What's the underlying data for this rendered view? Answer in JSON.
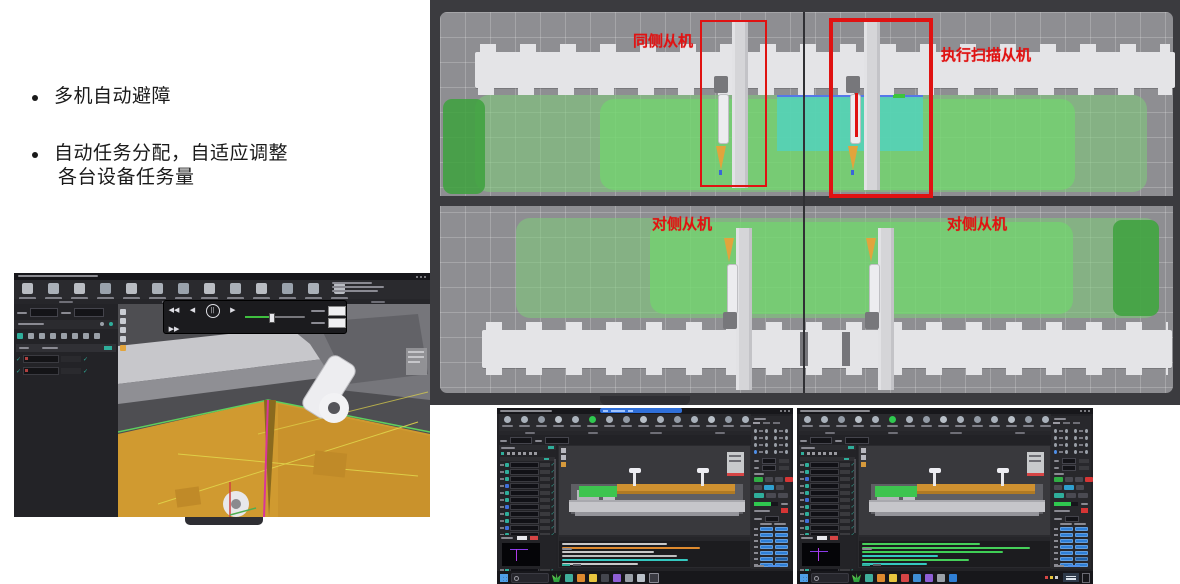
{
  "slide": {
    "bullet1": "多机自动避障",
    "bullet2_line1": "自动任务分配，自适应调整",
    "bullet2_line2": "各台设备任务量",
    "text_color": "#1a1a1a"
  },
  "sim_view": {
    "labels": {
      "same_side": "同侧从机",
      "scan_executor": "执行扫描从机",
      "opposite_left": "对侧从机",
      "opposite_right": "对侧从机"
    },
    "colors": {
      "annotation_red": "#e01212",
      "pale_green_zone": "#8fd48c",
      "bright_green_zone": "#7bdc78",
      "dark_green_zone": "#3da23d",
      "teal_zone": "#5ed2c4",
      "floor_gray": "#8e8e92",
      "frame_dark": "#3b3b3f",
      "rail_white": "#e4e4e7",
      "machine_gray": "#d5d5d8",
      "effector_orange": "#e2a43c",
      "scan_line_red": "#e01010"
    }
  },
  "viewer": {
    "toolbar_icons": [
      "#b9bcc2",
      "#aab0b8",
      "#b9bcc2",
      "#9aa2ac",
      "#b9bcc2",
      "#aab0b8",
      "#9aa2ac",
      "#b9bcc2",
      "#aab0b8",
      "#b9bcc2",
      "#9aa2ac",
      "#aab0b8",
      "#b9bcc2"
    ],
    "vstrip_icons": [
      "#c9ccd2",
      "#c9ccd2",
      "#c9ccd2",
      "#c9ccd2",
      "#e2a43c"
    ],
    "left_icons": [
      "#2fae9b",
      "#9aa0a8",
      "#9aa0a8",
      "#9aa0a8",
      "#9aa0a8",
      "#9aa0a8",
      "#9aa0a8",
      "#9aa0a8"
    ],
    "task_rows": [
      {
        "chip": "#b04040"
      },
      {
        "chip": "#b04040"
      }
    ],
    "player_buttons": [
      {
        "g": "◀◀"
      },
      {
        "g": "◀"
      },
      {
        "g": "||",
        "circle": true
      },
      {
        "g": "▶"
      },
      {
        "g": "▶▶"
      }
    ],
    "viewport_colors": {
      "floor_orange": "#d09a30",
      "edge_green": "#5ecf5e",
      "path_yellow": "#e0d44a",
      "seam_magenta": "#d8359a",
      "machine_light": "#c7c7cb"
    }
  },
  "dual": {
    "windows": [
      {
        "toolbar_icons": [
          "#aab2bc",
          "#aab2bc",
          "#939ba6",
          "#b9c0c8",
          "#aab2bc",
          "#2fc84f",
          "#aab2bc",
          "#939ba6",
          "#b9c0c8",
          "#aab2bc",
          "#939ba6",
          "#aab2bc",
          "#b9c0c8",
          "#939ba6",
          "#aab2bc"
        ],
        "row_chips": [
          "#2fae9b",
          "#2fae9b",
          "#2fae9b",
          "#3f6fd9",
          "#2fae9b",
          "#2fae9b",
          "#3f6fd9",
          "#2fae9b",
          "#2fae9b",
          "#3f6fd9",
          "#2fae9b",
          "#2fae9b",
          "#3f6fd9",
          "#2fae9b",
          "#2fae9b",
          "#2fae9b"
        ],
        "radio_rows": [
          {
            "c1": "#9aa0a8",
            "c2": "#9aa0a8",
            "c3": "#9aa0a8",
            "c4": "#9aa0a8"
          },
          {
            "c1": "#9aa0a8",
            "c2": "#9aa0a8",
            "c3": "#9aa0a8",
            "c4": "#9aa0a8"
          },
          {
            "c1": "#9aa0a8",
            "c2": "#9aa0a8",
            "c3": "#9aa0a8",
            "c4": "#9aa0a8"
          },
          {
            "c1": "#4f8fe8",
            "c2": "#9aa0a8",
            "c3": "#9aa0a8",
            "c4": "#9aa0a8"
          }
        ],
        "blue_rows": [
          {
            "a": "#2f7fd6",
            "b": "#2f7fd6"
          },
          {
            "a": "#2f7fd6",
            "b": "#2f7fd6"
          },
          {
            "a": "#2f7fd6",
            "b": "#2f7fd6"
          },
          {
            "a": "#2f7fd6",
            "b": "#2f7fd6"
          },
          {
            "a": "#2f7fd6",
            "b": "#2f7fd6"
          },
          {
            "a": "#2f7fd6",
            "b": "#1f5fa6"
          },
          {
            "a": "#2f7fd6",
            "b": "#2f7fd6"
          }
        ],
        "log_lines": [
          {
            "c": "#c8c8c8",
            "w": 55
          },
          {
            "c": "#de8a2e",
            "w": 72
          },
          {
            "c": "#c8c8c8",
            "w": 48
          },
          {
            "c": "#bfbfbf",
            "w": 60
          },
          {
            "c": "#35c8c0",
            "w": 66
          },
          {
            "c": "#c8c8c8",
            "w": 40
          }
        ],
        "taskbar_icons": [
          "#3fae9b",
          "#de8a2e",
          "#e8c53e",
          "#44464e",
          "#8f5fd6",
          "#9aa0a8",
          "#b9c0c8"
        ],
        "progress_green": "#2fc84f"
      },
      {
        "toolbar_icons": [
          "#aab2bc",
          "#aab2bc",
          "#939ba6",
          "#b9c0c8",
          "#aab2bc",
          "#2fc84f",
          "#aab2bc",
          "#939ba6",
          "#b9c0c8",
          "#aab2bc",
          "#939ba6",
          "#aab2bc",
          "#b9c0c8",
          "#939ba6",
          "#aab2bc"
        ],
        "row_chips": [
          "#2fae9b",
          "#2fae9b",
          "#3f6fd9",
          "#2fae9b",
          "#2fae9b",
          "#3f6fd9",
          "#2fae9b",
          "#2fae9b",
          "#3f6fd9",
          "#2fae9b",
          "#2fae9b",
          "#3f6fd9",
          "#2fae9b",
          "#2fae9b",
          "#3f6fd9",
          "#2fae9b"
        ],
        "radio_rows": [
          {
            "c1": "#9aa0a8",
            "c2": "#9aa0a8",
            "c3": "#9aa0a8",
            "c4": "#9aa0a8"
          },
          {
            "c1": "#9aa0a8",
            "c2": "#9aa0a8",
            "c3": "#9aa0a8",
            "c4": "#9aa0a8"
          },
          {
            "c1": "#9aa0a8",
            "c2": "#9aa0a8",
            "c3": "#9aa0a8",
            "c4": "#9aa0a8"
          },
          {
            "c1": "#4f8fe8",
            "c2": "#9aa0a8",
            "c3": "#9aa0a8",
            "c4": "#9aa0a8"
          }
        ],
        "blue_rows": [
          {
            "a": "#2f7fd6",
            "b": "#2f7fd6"
          },
          {
            "a": "#2f7fd6",
            "b": "#2f7fd6"
          },
          {
            "a": "#2f7fd6",
            "b": "#2f7fd6"
          },
          {
            "a": "#2f7fd6",
            "b": "#2f7fd6"
          },
          {
            "a": "#2f7fd6",
            "b": "#2f7fd6"
          },
          {
            "a": "#2f7fd6",
            "b": "#1f5fa6"
          },
          {
            "a": "#2f7fd6",
            "b": "#2f7fd6"
          }
        ],
        "log_lines": [
          {
            "c": "#46d05a",
            "w": 62
          },
          {
            "c": "#46d05a",
            "w": 88
          },
          {
            "c": "#3fcf55",
            "w": 74
          },
          {
            "c": "#35c8c0",
            "w": 40
          },
          {
            "c": "#46d05a",
            "w": 56
          },
          {
            "c": "#35c8c0",
            "w": 34
          }
        ],
        "taskbar_icons": [
          "#3fae9b",
          "#de8a2e",
          "#e8c53e",
          "#d64545",
          "#3f8fd6",
          "#8f5fd6",
          "#9aa0a8",
          "#2f7fd6"
        ],
        "progress_green": "#2fc84f"
      }
    ]
  }
}
